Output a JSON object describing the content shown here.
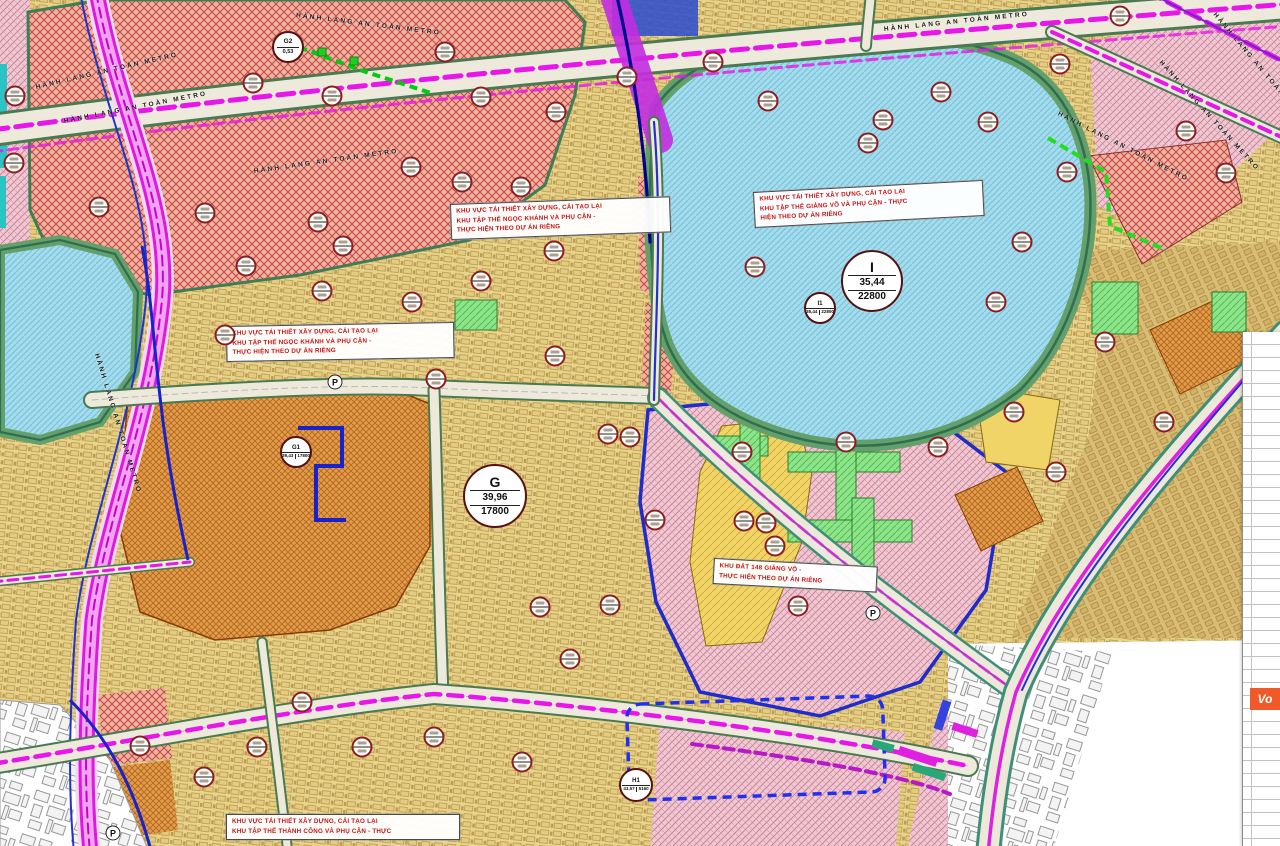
{
  "map": {
    "title": "Quy hoạch phân khu Giảng Võ - Ngọc Khánh - Thành Công",
    "metro_label": "HÀNH LANG AN TOÀN METRO",
    "metro_label_positions": [
      {
        "x": 36,
        "y": 84,
        "rot": -13
      },
      {
        "x": 64,
        "y": 118,
        "rot": -11
      },
      {
        "x": 296,
        "y": 12,
        "rot": 7
      },
      {
        "x": 884,
        "y": 26,
        "rot": -6
      },
      {
        "x": 1160,
        "y": 58,
        "rot": 48
      },
      {
        "x": 1058,
        "y": 110,
        "rot": 27
      },
      {
        "x": 254,
        "y": 168,
        "rot": -8
      },
      {
        "x": 96,
        "y": 350,
        "rot": 73
      },
      {
        "x": 1214,
        "y": 10,
        "rot": 50
      }
    ],
    "street_labels": [
      {
        "text": "PHỐ KIM MÃ",
        "x": 698,
        "y": 10,
        "rot": 4
      },
      {
        "text": "P. Kim Mã",
        "x": 788,
        "y": 8,
        "rot": 4
      },
      {
        "text": "P. Giảng Võ",
        "x": 740,
        "y": 36,
        "rot": 3
      },
      {
        "text": "Ngọc Khánh",
        "x": 280,
        "y": 381,
        "rot": 1
      },
      {
        "text": "P. Giảng Võ",
        "x": 172,
        "y": 401,
        "rot": 1
      },
      {
        "text": "Đường La Thành",
        "x": 444,
        "y": 683,
        "rot": -8
      },
      {
        "text": "PHỐ GIẢNG VÕ",
        "x": 894,
        "y": 638,
        "rot": 38
      },
      {
        "text": "Q. Đống Đa",
        "x": 26,
        "y": 700,
        "rot": 66
      }
    ],
    "area_labels": [
      {
        "text": "HỒ NGỌC KHÁNH",
        "x": 14,
        "y": 338,
        "kind": "water"
      },
      {
        "text": "HỒ GIẢNG VÕ",
        "x": 758,
        "y": 286,
        "kind": "water"
      },
      {
        "text": "PHƯỜNG GIẢNG VÕ",
        "x": 782,
        "y": 333,
        "kind": "ward"
      }
    ],
    "annotation_boxes": [
      {
        "x": 226,
        "y": 326,
        "w": 216,
        "rot": -1,
        "lines": [
          "KHU VỰC TÁI THIẾT XÂY DỰNG, CẢI TẠO LẠI",
          "KHU TẬP THỂ NGỌC KHÁNH VÀ PHỤ CẬN -",
          "THỰC HIỆN THEO DỰ ÁN RIÊNG"
        ]
      },
      {
        "x": 450,
        "y": 204,
        "w": 208,
        "rot": -2,
        "lines": [
          "KHU VỰC TÁI THIẾT XÂY DỰNG, CẢI TẠO LẠI",
          "KHU TẬP THỂ NGỌC KHÁNH VÀ PHỤ CẬN -",
          "THỰC HIỆN THEO DỰ ÁN RIÊNG"
        ]
      },
      {
        "x": 753,
        "y": 192,
        "w": 218,
        "rot": -3,
        "lines": [
          "KHU VỰC TÁI THIẾT XÂY DỰNG, CẢI TẠO LẠI",
          "KHU TẬP THỂ GIẢNG VÕ VÀ PHỤ CẬN - THỰC",
          "HIỆN THEO DỰ ÁN RIÊNG"
        ]
      },
      {
        "x": 714,
        "y": 558,
        "w": 152,
        "rot": 3,
        "lines": [
          "KHU ĐẤT 148 GIẢNG VÕ -",
          "THỰC HIỆN THEO DỰ ÁN RIÊNG"
        ]
      },
      {
        "x": 226,
        "y": 814,
        "w": 222,
        "rot": 0,
        "lines": [
          "KHU VỰC TÁI THIẾT XÂY DỰNG, CẢI TẠO LẠI",
          "KHU TẬP THỂ THÀNH CÔNG VÀ PHỤ CẬN - THỰC"
        ]
      }
    ],
    "major_markers": [
      {
        "id": "G2",
        "value": "0,53"
      },
      {
        "id": "I",
        "value": "35,44",
        "area": "22800"
      },
      {
        "id": "I1",
        "value": "35,44",
        "area": "22800"
      },
      {
        "id": "G",
        "value": "39,96",
        "area": "17800"
      },
      {
        "id": "G1",
        "value": "39,43",
        "area": "17800"
      },
      {
        "id": "H1",
        "value": "43,57",
        "area": "5160"
      }
    ],
    "small_markers": [
      [
        15,
        96
      ],
      [
        14,
        163
      ],
      [
        99,
        207
      ],
      [
        253,
        83
      ],
      [
        332,
        96
      ],
      [
        445,
        52
      ],
      [
        481,
        97
      ],
      [
        556,
        112
      ],
      [
        627,
        77
      ],
      [
        713,
        62
      ],
      [
        768,
        101
      ],
      [
        883,
        120
      ],
      [
        941,
        92
      ],
      [
        988,
        122
      ],
      [
        1060,
        64
      ],
      [
        1067,
        172
      ],
      [
        1120,
        16
      ],
      [
        1186,
        131
      ],
      [
        1226,
        173
      ],
      [
        205,
        213
      ],
      [
        246,
        266
      ],
      [
        318,
        222
      ],
      [
        343,
        246
      ],
      [
        411,
        167
      ],
      [
        462,
        182
      ],
      [
        521,
        187
      ],
      [
        554,
        251
      ],
      [
        481,
        281
      ],
      [
        412,
        302
      ],
      [
        322,
        291
      ],
      [
        225,
        335
      ],
      [
        436,
        379
      ],
      [
        555,
        356
      ],
      [
        608,
        434
      ],
      [
        630,
        437
      ],
      [
        655,
        520
      ],
      [
        610,
        605
      ],
      [
        570,
        659
      ],
      [
        540,
        607
      ],
      [
        742,
        452
      ],
      [
        846,
        442
      ],
      [
        938,
        447
      ],
      [
        1014,
        412
      ],
      [
        1056,
        472
      ],
      [
        775,
        546
      ],
      [
        744,
        521
      ],
      [
        766,
        523
      ],
      [
        798,
        606
      ],
      [
        1105,
        342
      ],
      [
        1022,
        242
      ],
      [
        996,
        302
      ],
      [
        1164,
        422
      ],
      [
        140,
        746
      ],
      [
        204,
        777
      ],
      [
        257,
        747
      ],
      [
        362,
        747
      ],
      [
        434,
        737
      ],
      [
        522,
        762
      ],
      [
        302,
        702
      ],
      [
        868,
        143
      ],
      [
        755,
        267
      ]
    ],
    "parking_symbol": "P",
    "parking_positions": [
      {
        "x": 335,
        "y": 382
      },
      {
        "x": 873,
        "y": 613
      },
      {
        "x": 113,
        "y": 833
      }
    ],
    "black_symbols": [
      {
        "x": 762,
        "y": 517,
        "glyph": "●"
      },
      {
        "x": 840,
        "y": 440,
        "glyph": "▲"
      },
      {
        "x": 312,
        "y": 322,
        "glyph": "●"
      },
      {
        "x": 571,
        "y": 662,
        "glyph": "●"
      },
      {
        "x": 418,
        "y": 65,
        "glyph": "●"
      }
    ],
    "marks": [
      {
        "x": 1153,
        "y": 707,
        "glyph": "+"
      },
      {
        "x": 1242,
        "y": 512,
        "glyph": "⊕"
      }
    ],
    "legend_logo": "Vo"
  },
  "colors": {
    "metro_magenta": "#ee16ee",
    "boundary_blue": "#1f2ccc",
    "green_line": "#00cc11",
    "lake": "#a5dcee",
    "residential_yellow": "#e8d48c",
    "redevelopment_orange": "#e49b4d",
    "mixed_rose": "#eec9d3",
    "park_green": "#8de489",
    "annotation_red": "#c81414"
  }
}
